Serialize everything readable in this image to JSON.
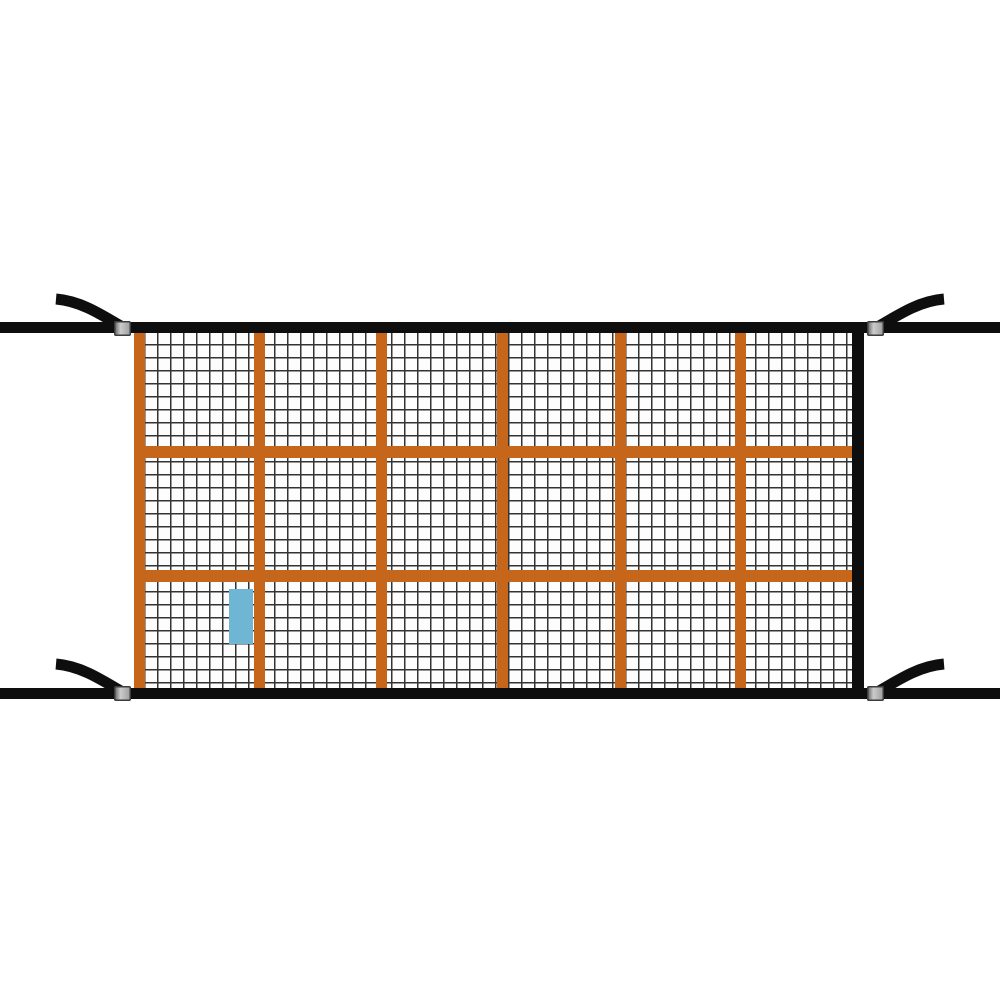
{
  "product_image": {
    "subject": "cargo-net",
    "description": "Rectangular cargo net with fine black mesh and an orange webbing grid, edged by black tie-down straps that extend past both sides with upward-angled loose ends and metal slide buckles at all four corners; a small blue fabric tag sits in the lower-left area of the net.",
    "grid": {
      "webbing_columns": 6,
      "webbing_rows": 3,
      "vertical_webbing_straps": 6,
      "horizontal_webbing_straps": 2,
      "mesh_pitch_px": 13
    },
    "hardware": {
      "buckle_count": 4,
      "loose_strap_end_count": 4
    },
    "colors": {
      "background": "#ffffff",
      "strap_black": "#0e0e0e",
      "webbing_orange": "#c6661a",
      "mesh_line": "#333333",
      "mesh_background": "#fdfdfd",
      "tag_blue": "#6fb6d4",
      "buckle_light": "#cccccc",
      "buckle_mid": "#9a9a9a",
      "buckle_dark": "#555555"
    }
  }
}
